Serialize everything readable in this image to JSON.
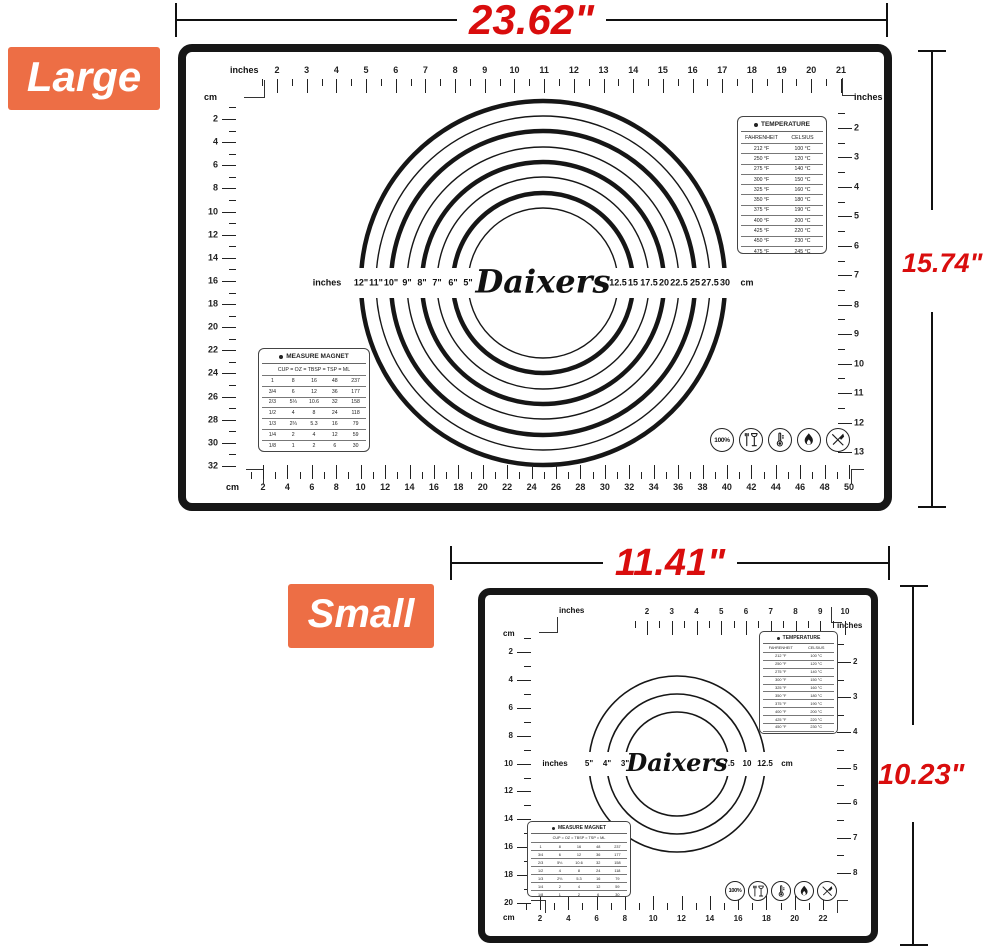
{
  "brand": "Daixers",
  "colors": {
    "accent_orange": "#ed6e45",
    "dimension_red": "#d90d0d",
    "mat_black": "#161616"
  },
  "temperature_table": {
    "title": "TEMPERATURE",
    "columns": [
      "FAHRENHEIT",
      "CELSIUS"
    ],
    "rows": [
      [
        "212 °F",
        "100 °C"
      ],
      [
        "250 °F",
        "120 °C"
      ],
      [
        "275 °F",
        "140 °C"
      ],
      [
        "300 °F",
        "150 °C"
      ],
      [
        "325 °F",
        "160 °C"
      ],
      [
        "350 °F",
        "180 °C"
      ],
      [
        "375 °F",
        "190 °C"
      ],
      [
        "400 °F",
        "200 °C"
      ],
      [
        "425 °F",
        "220 °C"
      ],
      [
        "450 °F",
        "230 °C"
      ],
      [
        "475 °F",
        "245 °C"
      ],
      [
        "500 °F",
        "260 °C"
      ]
    ]
  },
  "measure_table": {
    "title": "MEASURE MAGNET",
    "columns": [
      "CUP",
      "OZ",
      "TBSP",
      "TSP",
      "ML"
    ],
    "rows": [
      [
        "1",
        "8",
        "16",
        "48",
        "237"
      ],
      [
        "3/4",
        "6",
        "12",
        "36",
        "177"
      ],
      [
        "2/3",
        "5⅓",
        "10.6",
        "32",
        "158"
      ],
      [
        "1/2",
        "4",
        "8",
        "24",
        "118"
      ],
      [
        "1/3",
        "2⅔",
        "5.3",
        "16",
        "79"
      ],
      [
        "1/4",
        "2",
        "4",
        "12",
        "59"
      ],
      [
        "1/8",
        "1",
        "2",
        "6",
        "30"
      ],
      [
        "1/16",
        "1/2",
        "1",
        "3",
        "15"
      ]
    ]
  },
  "safety_icons": [
    {
      "name": "100-percent-seal-icon",
      "text": "100%"
    },
    {
      "name": "food-safe-glass-fork-icon",
      "glyph": "glass-fork"
    },
    {
      "name": "heat-resistant-thermometer-icon",
      "glyph": "thermometer"
    },
    {
      "name": "flame-resistant-icon",
      "glyph": "flame"
    },
    {
      "name": "no-sharp-objects-icon",
      "glyph": "no-knife"
    }
  ],
  "large": {
    "tag": "Large",
    "width_label": "23.62\"",
    "height_label": "15.74\"",
    "rulers": {
      "top": {
        "unit": "inches",
        "labels": [
          "2",
          "3",
          "4",
          "5",
          "6",
          "7",
          "8",
          "9",
          "10",
          "11",
          "12",
          "13",
          "14",
          "15",
          "16",
          "17",
          "18",
          "19",
          "20",
          "21"
        ]
      },
      "left": {
        "unit": "cm",
        "labels": [
          "2",
          "4",
          "6",
          "8",
          "10",
          "12",
          "14",
          "16",
          "18",
          "20",
          "22",
          "24",
          "26",
          "28",
          "30",
          "32"
        ]
      },
      "right": {
        "unit": "inches",
        "labels": [
          "2",
          "3",
          "4",
          "5",
          "6",
          "7",
          "8",
          "9",
          "10",
          "11",
          "12",
          "13"
        ]
      },
      "bottom": {
        "unit": "cm",
        "labels": [
          "2",
          "4",
          "6",
          "8",
          "10",
          "12",
          "14",
          "16",
          "18",
          "20",
          "22",
          "24",
          "26",
          "28",
          "30",
          "32",
          "34",
          "36",
          "38",
          "40",
          "42",
          "44",
          "46",
          "48",
          "50"
        ]
      }
    },
    "circles": {
      "left_unit": "inches",
      "right_unit": "cm",
      "brand": "Daixers",
      "inch_labels": [
        "12\"",
        "11\"",
        "10\"",
        "9\"",
        "8\"",
        "7\"",
        "6\"",
        "5\""
      ],
      "cm_labels": [
        "12.5",
        "15",
        "17.5",
        "20",
        "22.5",
        "25",
        "27.5",
        "30"
      ]
    }
  },
  "small": {
    "tag": "Small",
    "width_label": "11.41\"",
    "height_label": "10.23\"",
    "rulers": {
      "top": {
        "unit": "inches",
        "labels": [
          "2",
          "3",
          "4",
          "5",
          "6",
          "7",
          "8",
          "9",
          "10"
        ]
      },
      "left": {
        "unit": "cm",
        "labels": [
          "2",
          "4",
          "6",
          "8",
          "10",
          "12",
          "14",
          "16",
          "18",
          "20"
        ]
      },
      "right": {
        "unit": "inches",
        "labels": [
          "2",
          "3",
          "4",
          "5",
          "6",
          "7",
          "8"
        ]
      },
      "bottom": {
        "unit": "cm",
        "labels": [
          "2",
          "4",
          "6",
          "8",
          "10",
          "12",
          "14",
          "16",
          "18",
          "20",
          "22"
        ]
      }
    },
    "circles": {
      "left_unit": "inches",
      "right_unit": "cm",
      "brand": "Daixers",
      "inch_labels": [
        "5\"",
        "4\"",
        "3\""
      ],
      "cm_labels": [
        "7.5",
        "10",
        "12.5"
      ]
    }
  }
}
